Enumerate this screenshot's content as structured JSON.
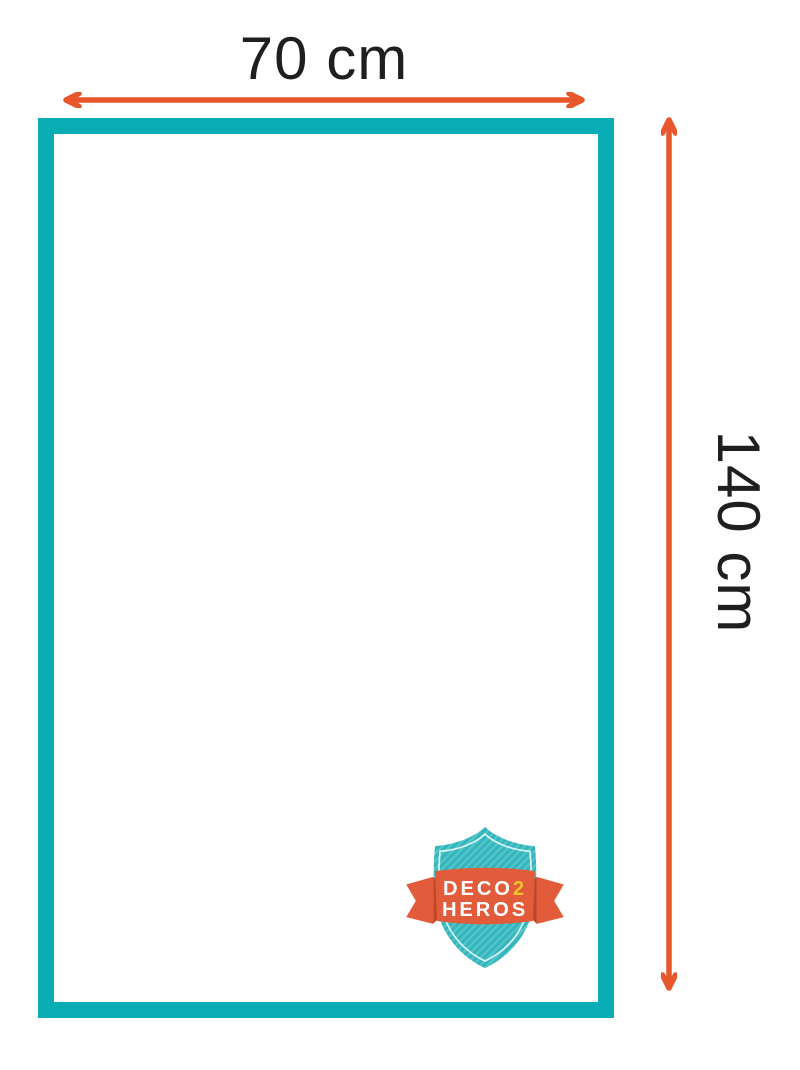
{
  "diagram": {
    "type": "product-dimensions",
    "width_label": "70 cm",
    "height_label": "140 cm"
  },
  "colors": {
    "background": "#ffffff",
    "label_text": "#1f1f21",
    "arrow": "#e8562b",
    "frame_teal": "#09abb5",
    "frame_fill": "#ffffff",
    "shield_teal": "#33b5bc",
    "shield_stripe_light": "#55c4ca",
    "shield_inner_line": "#dff5f5",
    "ribbon_orange": "#e25b3a",
    "ribbon_fold": "#bf4526",
    "logo_text_white": "#ffffff",
    "logo_text_yellow": "#f0c12f"
  },
  "logo": {
    "name": "DECO2HEROS badge",
    "line1_part1": "DECO",
    "line1_part2": "2",
    "line2": "HEROS"
  }
}
